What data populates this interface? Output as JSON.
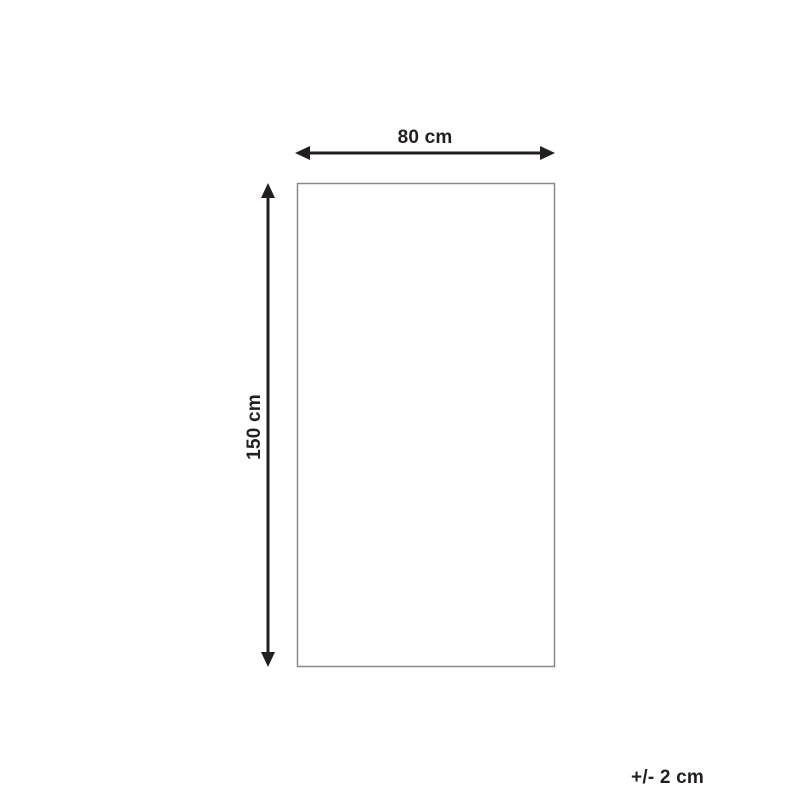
{
  "diagram": {
    "title": "Product dimensions diagram",
    "width_label": "80 cm",
    "height_label": "150 cm",
    "tolerance_label": "+/- 2 cm",
    "arrow_color": "#231f20",
    "outline_color": "#8a8a8a",
    "background_color": "#ffffff"
  }
}
